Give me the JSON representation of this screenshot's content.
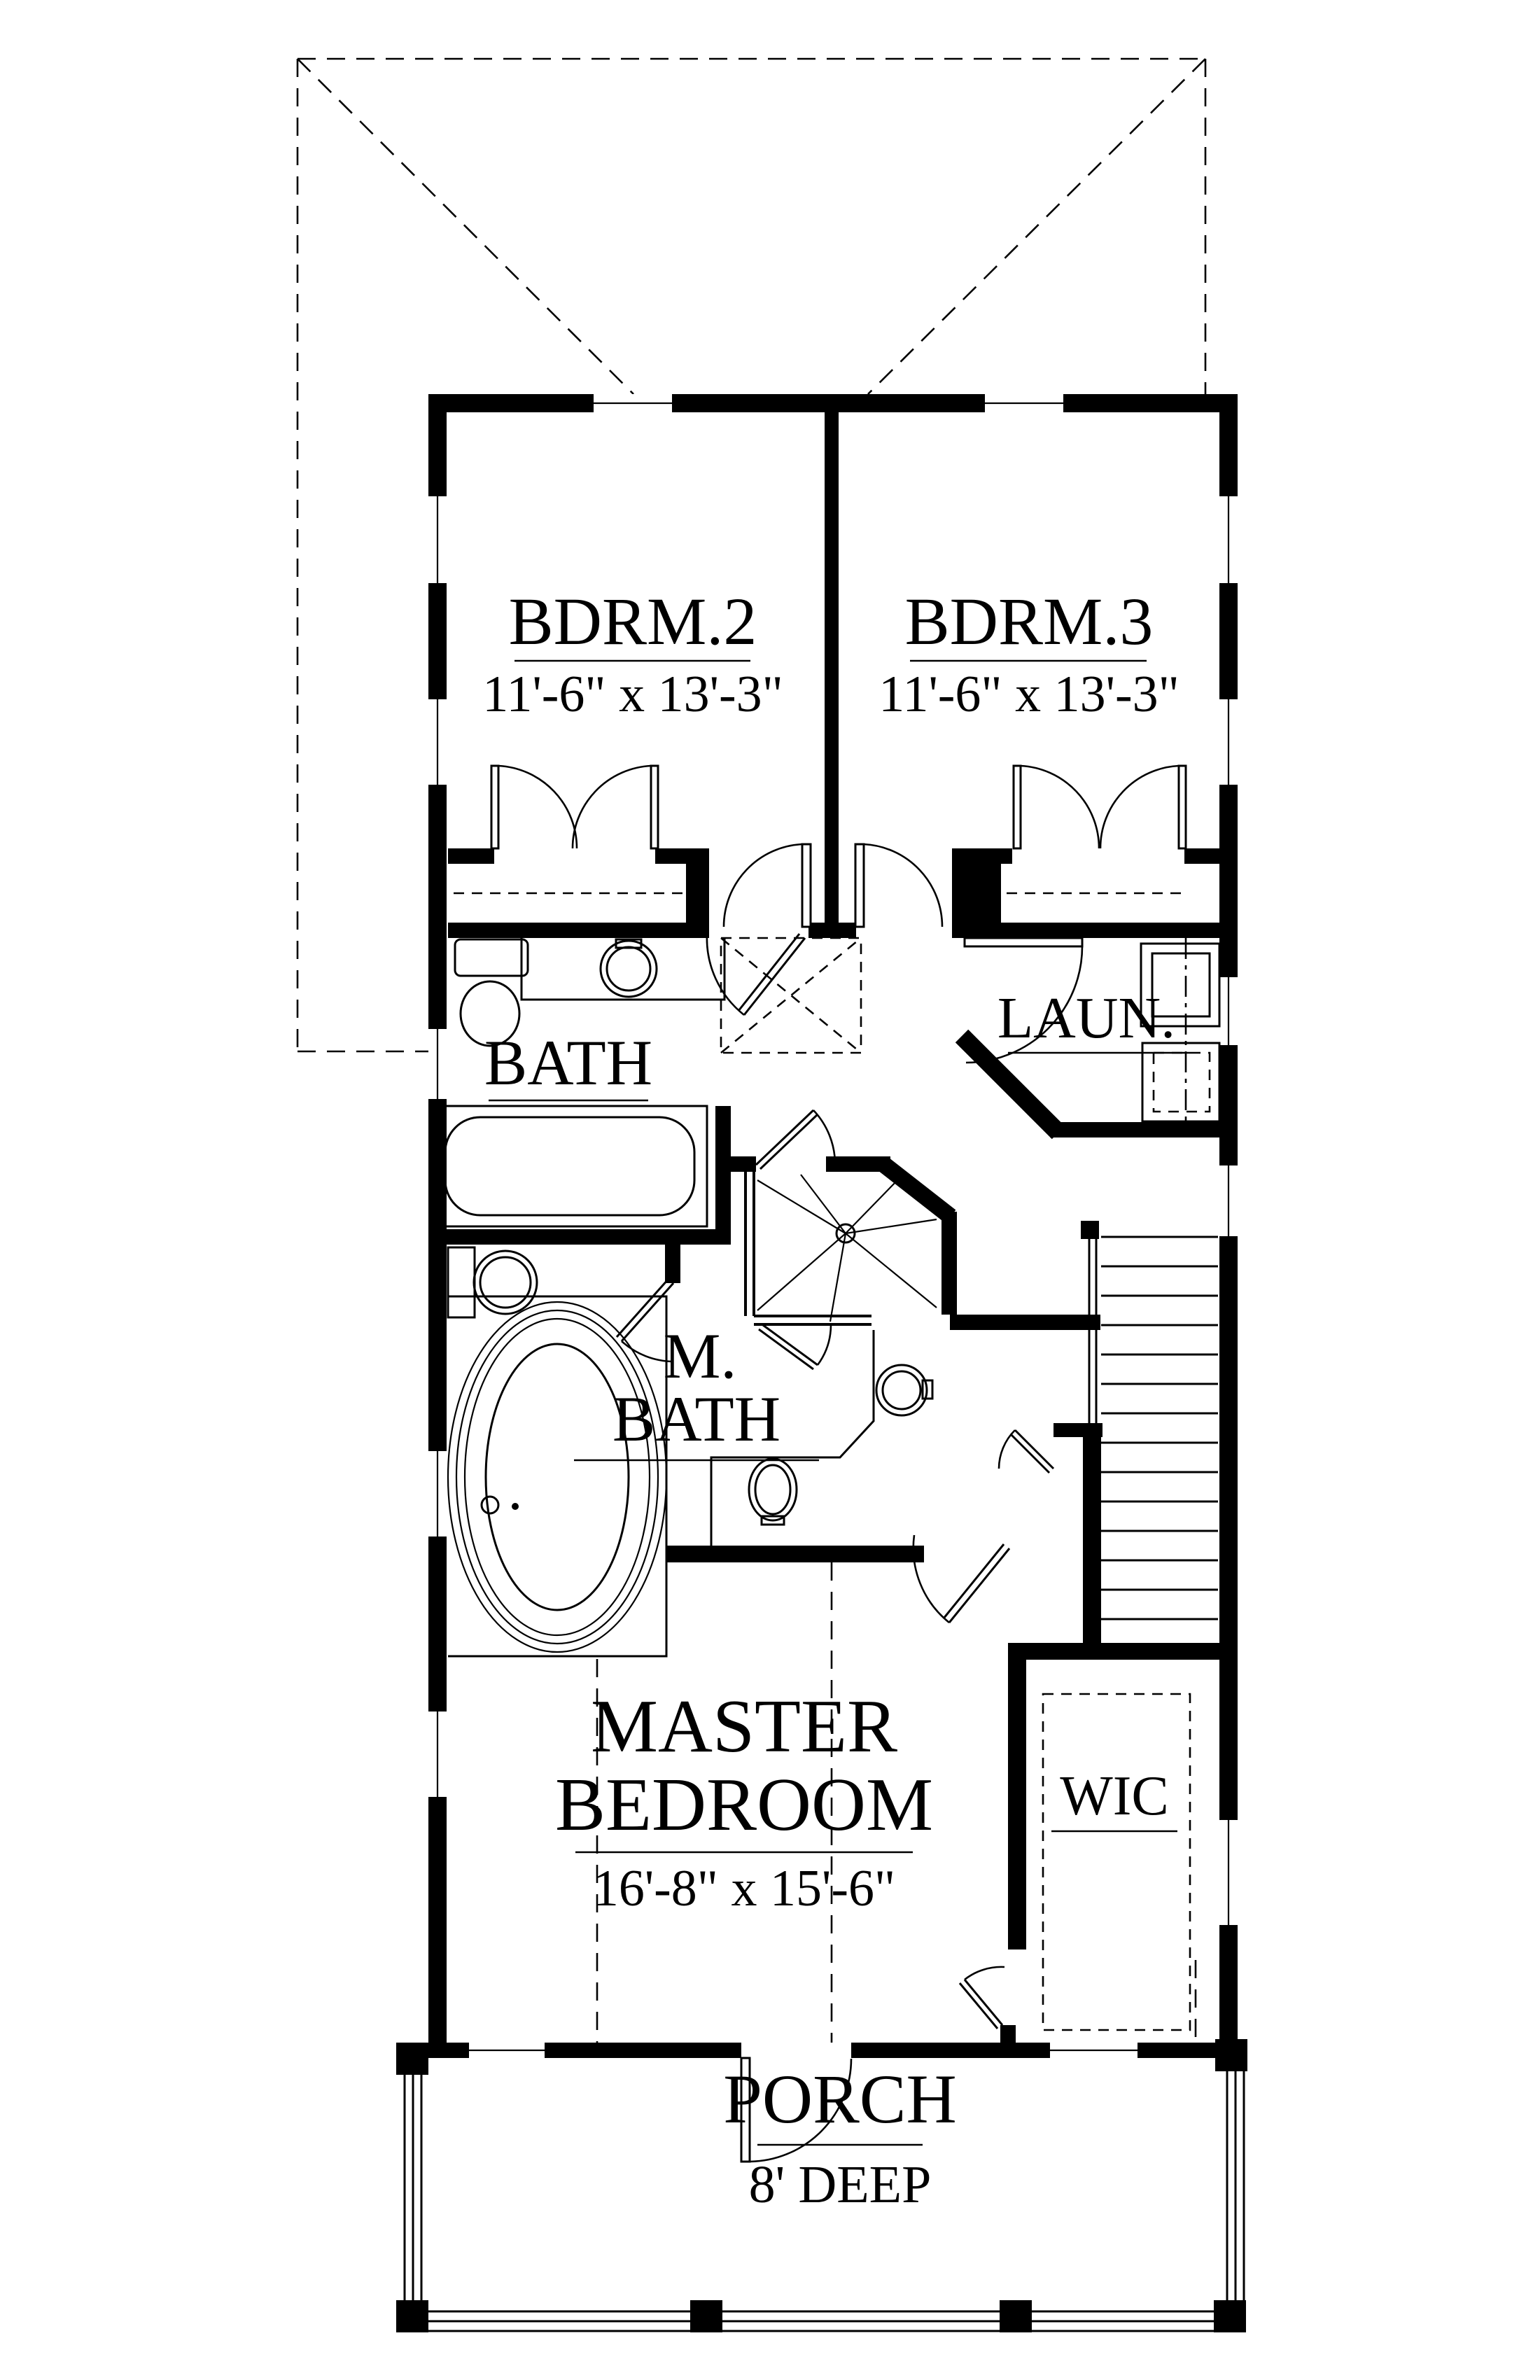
{
  "plan": {
    "rooms": {
      "bdrm2": {
        "name": "BDRM.2",
        "dims": "11'-6\" x 13'-3\""
      },
      "bdrm3": {
        "name": "BDRM.3",
        "dims": "11'-6\" x 13'-3\""
      },
      "bath": {
        "name": "BATH"
      },
      "laundry": {
        "name": "LAUN."
      },
      "mbath": {
        "line1": "M.",
        "line2": "BATH"
      },
      "master": {
        "line1": "MASTER",
        "line2": "BEDROOM",
        "dims": "16'-8\" x 15'-6\""
      },
      "wic": {
        "name": "WIC"
      },
      "porch": {
        "name": "PORCH",
        "dims": "8' DEEP"
      }
    },
    "colors": {
      "line": "#000000",
      "background": "#ffffff"
    }
  }
}
